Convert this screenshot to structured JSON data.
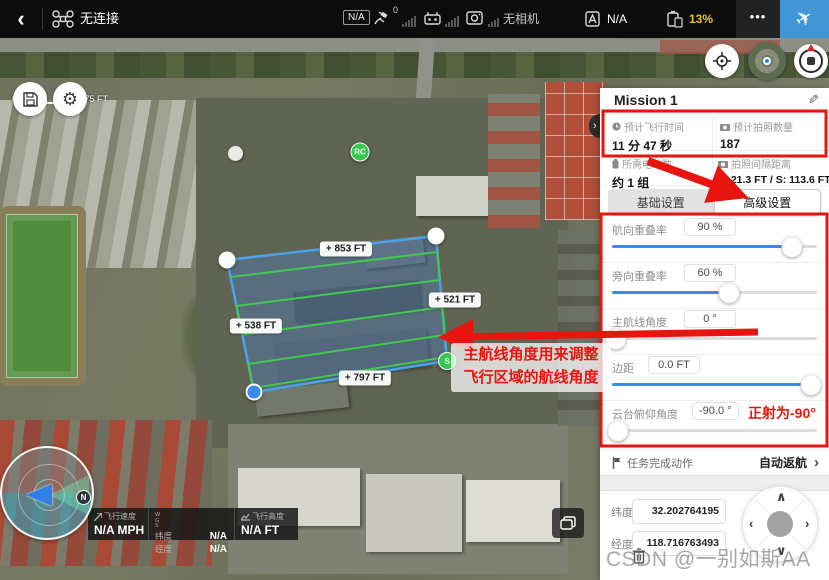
{
  "top_bar": {
    "back": "‹",
    "connection_status": "无连接",
    "aircraft_badge": "N/A",
    "gps_count": "0",
    "camera_status": "无相机",
    "flight_status": "N/A",
    "battery_percent": "13%",
    "more": "•••"
  },
  "map": {
    "scale_start": "0",
    "scale_end": "375 FT",
    "view_mode_label": "2D",
    "distances": {
      "top": "+ 853 FT",
      "right": "+ 521 FT",
      "left": "+ 538 FT",
      "bottom": "+ 797 FT"
    },
    "markers": {
      "rc": "RC",
      "start": "S"
    },
    "compass_north": "N"
  },
  "telemetry": {
    "speed_label": "飞行速度",
    "speed_value": "N/A MPH",
    "datum_w": "W",
    "datum_g": "G",
    "datum_s": "S",
    "lat_label": "纬度",
    "lat_value": "N/A",
    "lon_label": "经度",
    "lon_value": "N/A",
    "alt_label": "飞行高度",
    "alt_value": "N/A FT"
  },
  "panel": {
    "title": "Mission 1",
    "stats": [
      {
        "label": "预计飞行时间",
        "value": "11 分 47 秒"
      },
      {
        "label": "预计拍照数量",
        "value": "187"
      },
      {
        "label": "所需电池数",
        "value": "约 1 组"
      },
      {
        "label": "拍照间隔距离",
        "value": "F: 21.3 FT / S: 113.6 FT"
      }
    ],
    "tabs": {
      "basic": "基础设置",
      "advanced": "高级设置"
    },
    "sliders": [
      {
        "label": "航向重叠率",
        "value": "90 %",
        "percent": 88
      },
      {
        "label": "旁向重叠率",
        "value": "60 %",
        "percent": 57
      },
      {
        "label": "主航线角度",
        "value": "0 °",
        "percent": 2
      },
      {
        "label": "边距",
        "value": "0.0 FT",
        "percent": 97
      },
      {
        "label": "云台俯仰角度",
        "value": "-90.0 °",
        "percent": 3
      }
    ],
    "mission_end": {
      "label": "任务完成动作",
      "value": "自动返航",
      "chevron": "›"
    },
    "coords": {
      "lat_label": "纬度",
      "lat_value": "32.202764195",
      "lon_label": "经度",
      "lon_value": "118.716763493"
    }
  },
  "annotations": {
    "route_note_line1": "主航线角度用来调整",
    "route_note_line2": "飞行区域的航线角度",
    "ortho_note": "正射为-90°"
  },
  "watermark": "CSDN @一别如斯AA",
  "colors": {
    "accent_blue": "#3b8af0",
    "takeoff_blue": "#4197d5",
    "battery_warning": "#e6c229",
    "route_green": "#41c94f",
    "polygon_stroke": "#4aa3e8",
    "annotation_red": "#e8140e"
  }
}
